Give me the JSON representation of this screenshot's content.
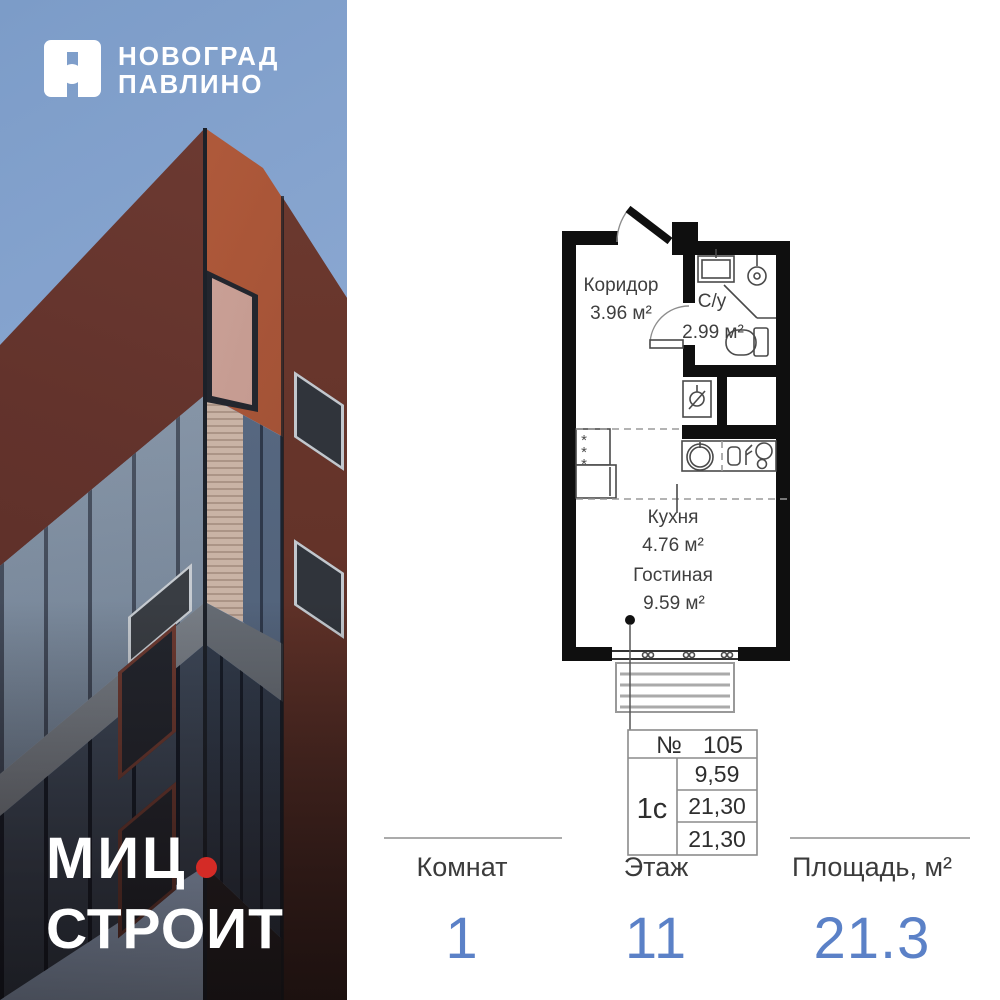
{
  "brand": {
    "project_name_line1": "НОВОГРАД",
    "project_name_line2": "ПАВЛИНО",
    "developer_line1": "МИЦ",
    "developer_line2": "СТРОИТ"
  },
  "floor_plan": {
    "rooms": [
      {
        "name": "Коридор",
        "area": "3.96 м²"
      },
      {
        "name": "С/у",
        "area": "2.99 м²"
      },
      {
        "name": "Кухня",
        "area": "4.76 м²"
      },
      {
        "name": "Гостиная",
        "area": "9.59 м²"
      }
    ],
    "closet_marks": [
      "*",
      "*",
      "*"
    ]
  },
  "spec_table": {
    "number_label": "№",
    "number": "105",
    "layout_type": "1с",
    "areas": [
      "9,59",
      "21,30",
      "21,30"
    ]
  },
  "stats": [
    {
      "label": "Комнат",
      "value": "1"
    },
    {
      "label": "Этаж",
      "value": "11"
    },
    {
      "label": "Площадь, м²",
      "value": "21.3"
    }
  ],
  "colors": {
    "accent_blue": "#5b81c7",
    "brand_red": "#d42b26"
  }
}
